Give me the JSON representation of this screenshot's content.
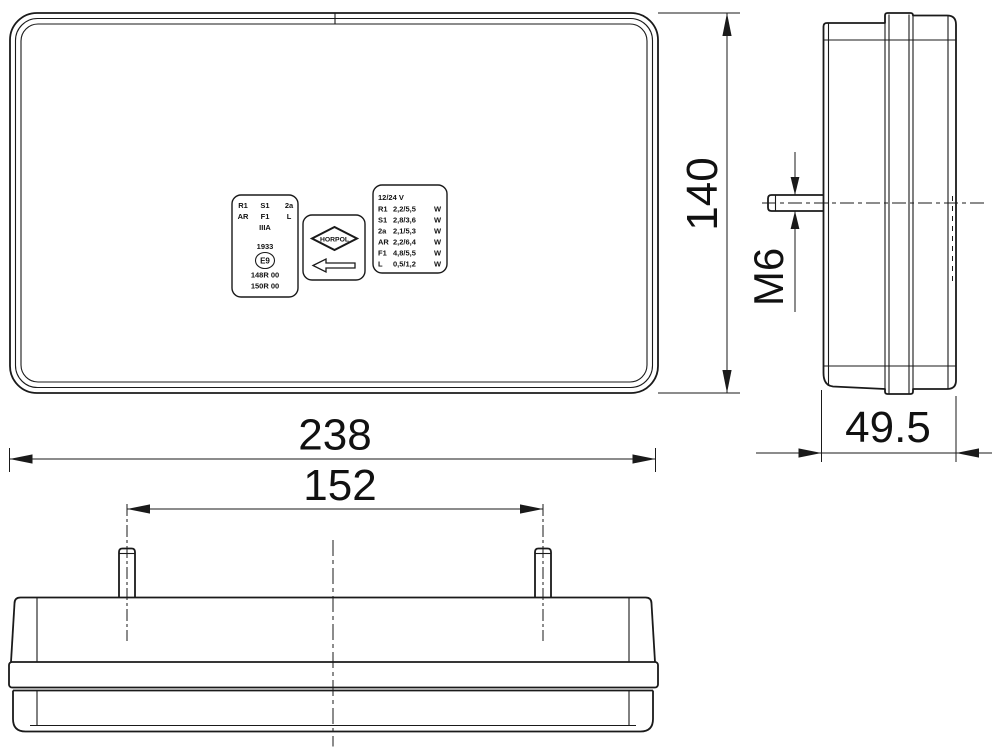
{
  "drawing": {
    "background": "#ffffff",
    "line_color": "#1a1a1a",
    "dims": {
      "height": "140",
      "width": "238",
      "stud_spacing": "152",
      "depth": "49.5",
      "thread": "M6"
    },
    "approval_label": {
      "row1": [
        "R1",
        "S1",
        "2a"
      ],
      "row2": [
        "AR",
        "F1",
        "L"
      ],
      "reflector_class": "IIIA",
      "number": "1933",
      "e_mark": "E9",
      "approval1": "148R 00",
      "approval2": "150R 00"
    },
    "brand_label": {
      "name": "HORPOL",
      "arrow_icon": "left-arrow"
    },
    "spec_label": {
      "voltage": "12/24 V",
      "rows": [
        {
          "code": "R1",
          "power": "2,2/5,5",
          "unit": "W"
        },
        {
          "code": "S1",
          "power": "2,8/3,6",
          "unit": "W"
        },
        {
          "code": "2a",
          "power": "2,1/5,3",
          "unit": "W"
        },
        {
          "code": "AR",
          "power": "2,2/6,4",
          "unit": "W"
        },
        {
          "code": "F1",
          "power": "4,8/5,5",
          "unit": "W"
        },
        {
          "code": "L",
          "power": "0,5/1,2",
          "unit": "W"
        }
      ]
    }
  }
}
